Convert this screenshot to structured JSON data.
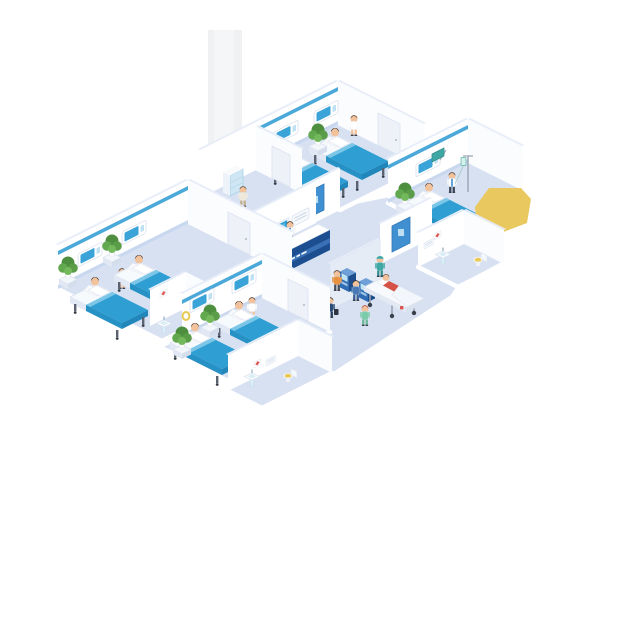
{
  "scene": {
    "title": "Isometric hospital floor illustration",
    "description": "Cutaway isometric illustration of a hospital floor: four patient wards with blue hospital beds and sitting patients, a private room with a doctor and IV stand, an exam room, a reception area with a dark blue desk, wall displays and two self check-in kiosks, a corridor with staff, a security officer, a green-uniformed nurse, a porter pushing a patient on a stretcher, three bathrooms with sinks and toilets, potted plants, and a yellow highlight shape at the right.",
    "background": "#ffffff"
  },
  "palette": {
    "floor": "#d7e1f2",
    "wall": "#ffffff",
    "accent_blue": "#2e9ed3",
    "rail_blue": "#4aa9d8",
    "desk_blue": "#16406f",
    "door_blue": "#3f8fd1",
    "glass_blue": "#cfe7f5",
    "plant_green": "#4e8f3f",
    "scrub_teal": "#3fa8a5",
    "nurse_green": "#7ccbaa",
    "highlight_yellow": "#e9c95f",
    "toilet_seat_yellow": "#e9ca55"
  },
  "rooms": [
    {
      "id": "top-ward",
      "name": "Patient ward (top)",
      "beds": 2,
      "staff": [
        "nurse"
      ],
      "plants": 1
    },
    {
      "id": "right-room",
      "name": "Private patient room",
      "beds": 1,
      "staff": [
        "doctor"
      ],
      "equipment": [
        "iv-stand",
        "overhead-monitor"
      ],
      "plants": 1
    },
    {
      "id": "right-bathroom",
      "name": "Bathroom (right)",
      "fixtures": [
        "sink",
        "mirror",
        "toilet",
        "first-aid-kit"
      ]
    },
    {
      "id": "exam-room",
      "name": "Exam room",
      "people": [
        "patient"
      ],
      "equipment": [
        "supply-cabinet"
      ]
    },
    {
      "id": "reception",
      "name": "Reception",
      "staff": [
        "receptionist"
      ],
      "equipment": [
        "wall-displays",
        "reception-desk",
        "laptop"
      ]
    },
    {
      "id": "checkin-area",
      "name": "Self check-in",
      "kiosks": 2,
      "visitors": [
        "orange-shirt-visitor",
        "blue-shirt-visitor"
      ]
    },
    {
      "id": "corridor",
      "name": "Corridor",
      "people": [
        "security-officer",
        "staff-member",
        "green-nurse",
        "porter",
        "stretcher-patient"
      ]
    },
    {
      "id": "left-ward",
      "name": "Patient ward (left)",
      "beds": 2,
      "staff": [
        "nurse"
      ],
      "plants": 2
    },
    {
      "id": "left-washroom",
      "name": "Washroom (left)",
      "fixtures": [
        "sink",
        "towel-ring",
        "first-aid-kit"
      ]
    },
    {
      "id": "bottom-ward",
      "name": "Patient ward (bottom)",
      "beds": 2,
      "staff": [
        "nurse"
      ],
      "plants": 2
    },
    {
      "id": "bottom-bathroom",
      "name": "Bathroom (bottom)",
      "fixtures": [
        "sink",
        "mirror",
        "toilet",
        "first-aid-kit"
      ]
    }
  ],
  "totals": {
    "beds": 7,
    "stretchers": 1,
    "people": 20,
    "plants": 6,
    "kiosks": 2,
    "wall_displays": 3,
    "bathrooms": 3
  }
}
